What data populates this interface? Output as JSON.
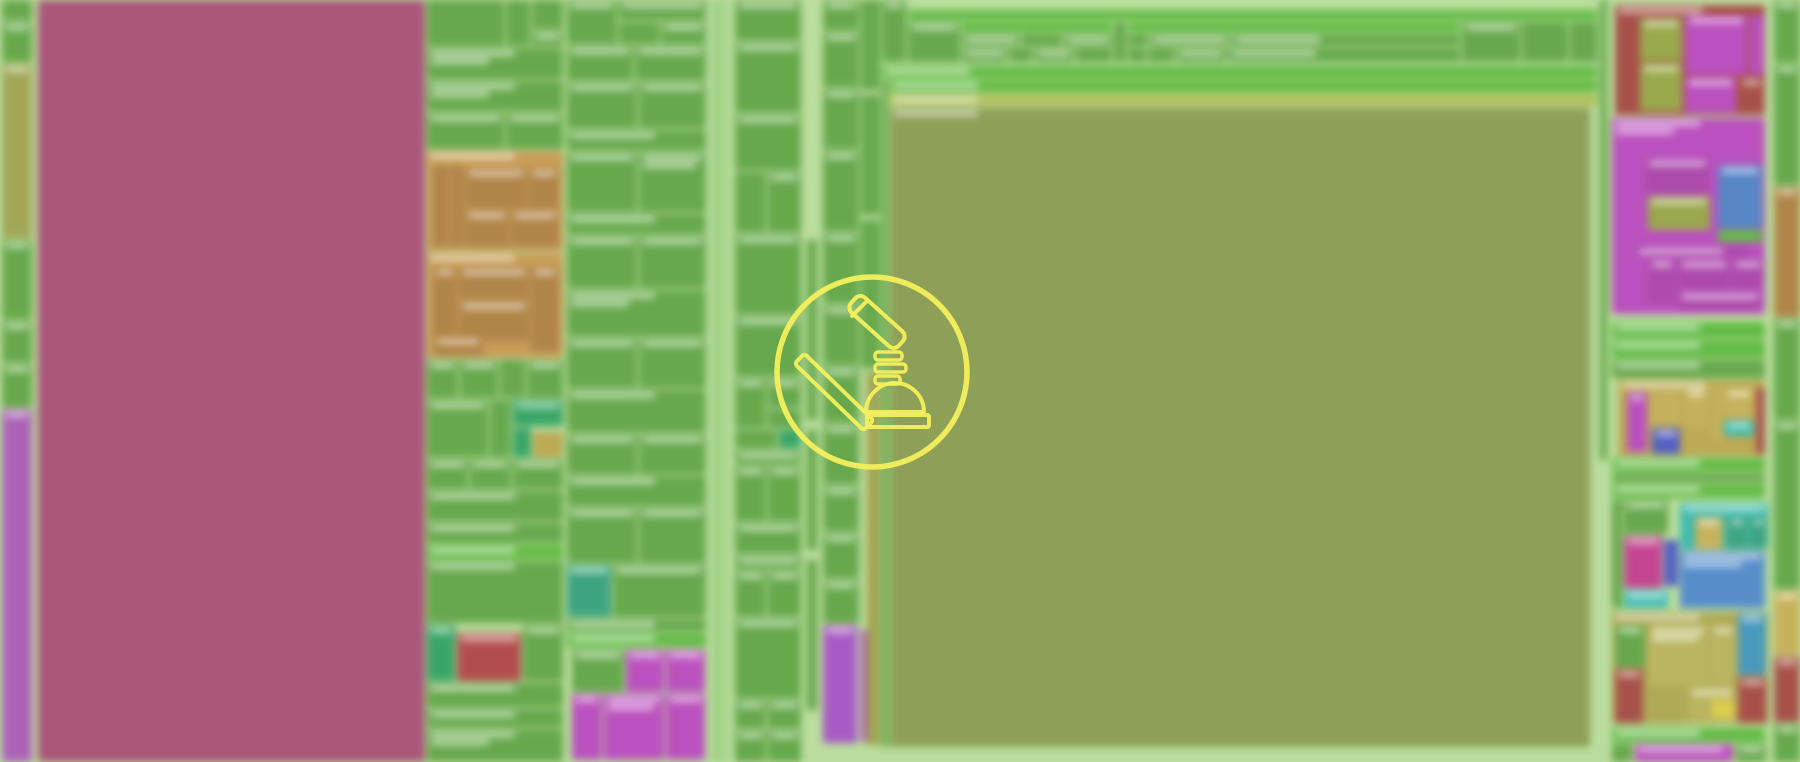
{
  "canvas": {
    "width": 1800,
    "height": 762,
    "background_color": "#b7dc98",
    "background_blur_px": 4,
    "description": "blurred treemap profiler viewport, all tile label text illegible due to blur"
  },
  "overlay_icon": {
    "name": "gavel-icon",
    "shape": "outlined gavel with spring threads and dome base inside a circle",
    "stroke_color": "#f4f05c",
    "center_x": 872,
    "center_y": 372,
    "circle_radius": 95
  },
  "palette": {
    "g": "#5ba23e",
    "gd": "#509539",
    "gb": "#57b637",
    "gl": "#8cc86e",
    "ol": "#85984a",
    "oll": "#a9ba4e",
    "olt": "#9aa04a",
    "o2": "#92a23d",
    "mr": "#a64b72",
    "pu": "#a757b4",
    "pm": "#a34fc2",
    "mg": "#b845bc",
    "mgd": "#a93fa9",
    "tn": "#c49549",
    "tnd": "#ab7c3a",
    "rd": "#a4463e",
    "rd2": "#b04242",
    "bl": "#4a7fc2",
    "bl2": "#4a86c8",
    "bl3": "#3a92b8",
    "in": "#4a56c0",
    "te": "#2f9e78",
    "te2": "#2fb6a6",
    "te3": "#38b8b0",
    "em": "#2aa05c",
    "kh": "#b8a245",
    "kh2": "#c0ab4e",
    "kh3": "#a8a348",
    "kh3l": "#b3ae52",
    "ks": "#9a9c42",
    "ye": "#d8c83a",
    "cr": "#c23a8c"
  },
  "tiles": [
    [
      2,
      0,
      30,
      20,
      "g",
      0
    ],
    [
      2,
      22,
      30,
      40,
      "g",
      1
    ],
    [
      2,
      64,
      30,
      174,
      "olt",
      1
    ],
    [
      2,
      240,
      30,
      79,
      "g",
      1
    ],
    [
      2,
      321,
      30,
      41,
      "g",
      1
    ],
    [
      2,
      364,
      30,
      43,
      "g",
      1
    ],
    [
      2,
      409,
      30,
      353,
      "pu",
      1
    ],
    [
      38,
      0,
      387,
      762,
      "mr",
      0
    ],
    [
      427,
      0,
      77,
      46,
      "g",
      0
    ],
    [
      506,
      0,
      24,
      46,
      "g",
      0
    ],
    [
      532,
      0,
      31,
      29,
      "g",
      0
    ],
    [
      532,
      31,
      31,
      15,
      "g",
      1
    ],
    [
      427,
      48,
      136,
      31,
      "g",
      2
    ],
    [
      427,
      81,
      136,
      30,
      "g",
      2
    ],
    [
      427,
      113,
      77,
      36,
      "g",
      1
    ],
    [
      506,
      113,
      57,
      36,
      "g",
      1
    ],
    [
      427,
      151,
      136,
      100,
      "tn",
      1
    ],
    [
      433,
      165,
      16,
      82,
      "tnd",
      0
    ],
    [
      451,
      165,
      12,
      82,
      "tnd",
      0
    ],
    [
      465,
      168,
      62,
      40,
      "tnd",
      1
    ],
    [
      529,
      168,
      30,
      40,
      "tnd",
      1
    ],
    [
      465,
      210,
      44,
      37,
      "tnd",
      1
    ],
    [
      511,
      210,
      48,
      37,
      "tnd",
      1
    ],
    [
      427,
      253,
      136,
      105,
      "tn",
      1
    ],
    [
      433,
      267,
      24,
      84,
      "tnd",
      1
    ],
    [
      459,
      267,
      70,
      32,
      "tnd",
      1
    ],
    [
      459,
      301,
      70,
      40,
      "tnd",
      1
    ],
    [
      531,
      267,
      28,
      84,
      "tnd",
      1
    ],
    [
      433,
      336,
      50,
      20,
      "tnd",
      1
    ],
    [
      427,
      360,
      31,
      38,
      "g",
      1
    ],
    [
      460,
      360,
      38,
      38,
      "g",
      1
    ],
    [
      500,
      360,
      25,
      38,
      "g",
      0
    ],
    [
      527,
      360,
      36,
      38,
      "g",
      1
    ],
    [
      427,
      400,
      61,
      57,
      "g",
      1
    ],
    [
      490,
      400,
      21,
      57,
      "g",
      0
    ],
    [
      513,
      400,
      50,
      26,
      "em",
      1
    ],
    [
      513,
      428,
      18,
      29,
      "em",
      0
    ],
    [
      533,
      432,
      30,
      25,
      "kh",
      0
    ],
    [
      427,
      459,
      41,
      30,
      "g",
      1
    ],
    [
      470,
      459,
      41,
      30,
      "g",
      1
    ],
    [
      513,
      459,
      50,
      30,
      "g",
      1
    ],
    [
      427,
      491,
      136,
      30,
      "g",
      1
    ],
    [
      427,
      523,
      136,
      20,
      "g",
      1
    ],
    [
      427,
      545,
      136,
      14,
      "gb",
      1
    ],
    [
      427,
      561,
      136,
      62,
      "g",
      1
    ],
    [
      427,
      625,
      28,
      56,
      "em",
      1
    ],
    [
      457,
      633,
      64,
      48,
      "rd2",
      1
    ],
    [
      523,
      625,
      40,
      56,
      "g",
      1
    ],
    [
      427,
      683,
      136,
      24,
      "g",
      1
    ],
    [
      427,
      709,
      136,
      18,
      "g",
      1
    ],
    [
      427,
      729,
      136,
      33,
      "g",
      2
    ],
    [
      567,
      0,
      50,
      44,
      "g",
      1
    ],
    [
      619,
      0,
      87,
      20,
      "g",
      1
    ],
    [
      619,
      22,
      40,
      22,
      "g",
      0
    ],
    [
      661,
      22,
      45,
      22,
      "g",
      1
    ],
    [
      567,
      46,
      66,
      34,
      "g",
      1
    ],
    [
      635,
      46,
      71,
      34,
      "g",
      1
    ],
    [
      567,
      82,
      70,
      46,
      "g",
      1
    ],
    [
      639,
      82,
      67,
      46,
      "g",
      1
    ],
    [
      567,
      130,
      139,
      20,
      "g",
      1
    ],
    [
      567,
      152,
      70,
      60,
      "g",
      1
    ],
    [
      639,
      152,
      67,
      60,
      "g",
      2
    ],
    [
      567,
      214,
      139,
      20,
      "g",
      1
    ],
    [
      567,
      236,
      70,
      52,
      "g",
      1
    ],
    [
      639,
      236,
      67,
      52,
      "g",
      1
    ],
    [
      567,
      290,
      139,
      46,
      "g",
      2
    ],
    [
      567,
      338,
      70,
      50,
      "g",
      1
    ],
    [
      639,
      338,
      67,
      50,
      "g",
      1
    ],
    [
      567,
      390,
      139,
      42,
      "g",
      1
    ],
    [
      567,
      434,
      70,
      40,
      "g",
      1
    ],
    [
      639,
      434,
      67,
      40,
      "g",
      1
    ],
    [
      567,
      476,
      139,
      30,
      "g",
      1
    ],
    [
      567,
      508,
      70,
      55,
      "g",
      1
    ],
    [
      639,
      508,
      67,
      55,
      "g",
      1
    ],
    [
      567,
      565,
      44,
      52,
      "te",
      1
    ],
    [
      613,
      565,
      93,
      52,
      "g",
      1
    ],
    [
      567,
      619,
      139,
      12,
      "g",
      1
    ],
    [
      567,
      633,
      139,
      14,
      "gb",
      1
    ],
    [
      572,
      650,
      52,
      42,
      "g",
      1
    ],
    [
      626,
      650,
      38,
      42,
      "mg",
      1
    ],
    [
      666,
      650,
      39,
      42,
      "mg",
      1
    ],
    [
      572,
      694,
      30,
      66,
      "mg",
      1
    ],
    [
      604,
      694,
      60,
      66,
      "mg",
      2
    ],
    [
      666,
      694,
      39,
      66,
      "mg",
      1
    ],
    [
      713,
      0,
      6,
      762,
      "gl",
      0
    ],
    [
      722,
      0,
      4,
      762,
      "gl",
      0
    ],
    [
      807,
      240,
      10,
      180,
      "g",
      0
    ],
    [
      807,
      430,
      10,
      120,
      "g",
      0
    ],
    [
      807,
      560,
      10,
      150,
      "g",
      0
    ],
    [
      735,
      0,
      66,
      40,
      "g",
      1
    ],
    [
      735,
      42,
      66,
      70,
      "g",
      1
    ],
    [
      735,
      114,
      66,
      56,
      "g",
      1
    ],
    [
      735,
      172,
      31,
      60,
      "g",
      0
    ],
    [
      768,
      172,
      33,
      60,
      "g",
      1
    ],
    [
      735,
      234,
      66,
      80,
      "g",
      1
    ],
    [
      735,
      316,
      66,
      60,
      "g",
      1
    ],
    [
      735,
      378,
      31,
      50,
      "g",
      1
    ],
    [
      768,
      378,
      33,
      30,
      "g",
      1
    ],
    [
      768,
      410,
      33,
      18,
      "g",
      0
    ],
    [
      735,
      430,
      42,
      18,
      "g",
      0
    ],
    [
      779,
      430,
      22,
      18,
      "em",
      0
    ],
    [
      735,
      450,
      66,
      14,
      "g",
      1
    ],
    [
      735,
      466,
      31,
      55,
      "g",
      1
    ],
    [
      768,
      466,
      33,
      55,
      "g",
      1
    ],
    [
      735,
      523,
      66,
      30,
      "g",
      1
    ],
    [
      735,
      555,
      66,
      14,
      "g",
      1
    ],
    [
      735,
      571,
      31,
      45,
      "g",
      1
    ],
    [
      768,
      571,
      33,
      45,
      "g",
      1
    ],
    [
      735,
      618,
      66,
      80,
      "g",
      1
    ],
    [
      735,
      700,
      31,
      28,
      "g",
      1
    ],
    [
      768,
      700,
      33,
      28,
      "g",
      1
    ],
    [
      735,
      730,
      31,
      32,
      "g",
      1
    ],
    [
      768,
      730,
      33,
      32,
      "g",
      1
    ],
    [
      823,
      0,
      36,
      30,
      "g",
      1
    ],
    [
      823,
      32,
      36,
      55,
      "g",
      1
    ],
    [
      823,
      89,
      36,
      60,
      "g",
      1
    ],
    [
      823,
      151,
      36,
      80,
      "g",
      1
    ],
    [
      823,
      233,
      36,
      70,
      "g",
      1
    ],
    [
      823,
      305,
      36,
      60,
      "g",
      1
    ],
    [
      823,
      367,
      36,
      55,
      "g",
      1
    ],
    [
      823,
      424,
      36,
      60,
      "g",
      1
    ],
    [
      823,
      486,
      36,
      45,
      "g",
      1
    ],
    [
      823,
      533,
      36,
      45,
      "g",
      1
    ],
    [
      823,
      580,
      36,
      43,
      "g",
      1
    ],
    [
      823,
      625,
      34,
      118,
      "pm",
      1
    ],
    [
      861,
      630,
      8,
      112,
      "pu",
      0
    ],
    [
      861,
      0,
      19,
      90,
      "g",
      0
    ],
    [
      861,
      95,
      19,
      120,
      "g",
      0
    ],
    [
      861,
      220,
      19,
      148,
      "g",
      0
    ],
    [
      867,
      372,
      13,
      373,
      "ks",
      0
    ],
    [
      882,
      0,
      24,
      62,
      "g",
      1
    ],
    [
      908,
      10,
      689,
      10,
      "gb",
      1
    ],
    [
      908,
      22,
      52,
      40,
      "g",
      1
    ],
    [
      962,
      22,
      150,
      10,
      "gb",
      1
    ],
    [
      962,
      34,
      58,
      12,
      "g",
      1
    ],
    [
      1022,
      34,
      40,
      12,
      "g",
      0
    ],
    [
      1064,
      34,
      48,
      12,
      "g",
      1
    ],
    [
      962,
      48,
      46,
      14,
      "g",
      1
    ],
    [
      1010,
      48,
      22,
      14,
      "g",
      0
    ],
    [
      1034,
      48,
      40,
      14,
      "g",
      1
    ],
    [
      1076,
      48,
      36,
      14,
      "g",
      0
    ],
    [
      1114,
      22,
      12,
      40,
      "g",
      0
    ],
    [
      1128,
      22,
      332,
      10,
      "gb",
      1
    ],
    [
      1128,
      34,
      20,
      12,
      "g",
      0
    ],
    [
      1150,
      34,
      80,
      12,
      "g",
      1
    ],
    [
      1232,
      34,
      228,
      12,
      "g",
      1
    ],
    [
      1128,
      48,
      18,
      14,
      "g",
      0
    ],
    [
      1148,
      48,
      26,
      14,
      "g",
      0
    ],
    [
      1176,
      48,
      50,
      14,
      "g",
      1
    ],
    [
      1228,
      48,
      232,
      14,
      "g",
      1
    ],
    [
      1462,
      22,
      58,
      40,
      "g",
      1
    ],
    [
      1522,
      22,
      46,
      40,
      "g",
      0
    ],
    [
      1570,
      22,
      27,
      40,
      "g",
      0
    ],
    [
      882,
      66,
      715,
      12,
      "gb",
      1
    ],
    [
      882,
      80,
      6,
      667,
      "g",
      0
    ],
    [
      890,
      80,
      707,
      12,
      "gb",
      1
    ],
    [
      890,
      94,
      707,
      12,
      "oll",
      1
    ],
    [
      890,
      108,
      700,
      639,
      "ol",
      1
    ],
    [
      1600,
      0,
      7,
      460,
      "g",
      0
    ],
    [
      1615,
      5,
      150,
      110,
      "rd",
      1
    ],
    [
      1640,
      18,
      42,
      43,
      "o2",
      1
    ],
    [
      1640,
      63,
      42,
      48,
      "o2",
      1
    ],
    [
      1685,
      15,
      62,
      60,
      "mg",
      1
    ],
    [
      1750,
      15,
      14,
      60,
      "mg",
      0
    ],
    [
      1685,
      77,
      51,
      36,
      "mg",
      1
    ],
    [
      1739,
      77,
      25,
      36,
      "rd",
      1
    ],
    [
      1612,
      118,
      153,
      196,
      "mg",
      2
    ],
    [
      1645,
      158,
      65,
      36,
      "mgd",
      1
    ],
    [
      1718,
      165,
      44,
      63,
      "bl",
      1
    ],
    [
      1648,
      196,
      62,
      34,
      "o2",
      1
    ],
    [
      1718,
      230,
      44,
      12,
      "gb",
      0
    ],
    [
      1635,
      246,
      112,
      11,
      "mgd",
      1
    ],
    [
      1648,
      259,
      28,
      44,
      "mgd",
      1
    ],
    [
      1678,
      259,
      52,
      30,
      "mgd",
      1
    ],
    [
      1732,
      259,
      32,
      30,
      "mgd",
      1
    ],
    [
      1678,
      291,
      84,
      19,
      "mgd",
      1
    ],
    [
      1612,
      322,
      153,
      16,
      "gb",
      1
    ],
    [
      1612,
      340,
      153,
      18,
      "gb",
      1
    ],
    [
      1612,
      360,
      153,
      18,
      "g",
      1
    ],
    [
      1618,
      380,
      147,
      76,
      "kh",
      1
    ],
    [
      1627,
      392,
      20,
      60,
      "mg",
      1
    ],
    [
      1650,
      392,
      30,
      32,
      "kh2",
      0
    ],
    [
      1652,
      428,
      28,
      26,
      "in",
      1
    ],
    [
      1684,
      388,
      24,
      40,
      "kh2",
      1
    ],
    [
      1712,
      385,
      10,
      55,
      "kh2",
      0
    ],
    [
      1724,
      420,
      30,
      16,
      "te2",
      1
    ],
    [
      1724,
      388,
      30,
      30,
      "kh2",
      1
    ],
    [
      1756,
      388,
      9,
      66,
      "rd",
      0
    ],
    [
      1612,
      458,
      153,
      14,
      "gb",
      1
    ],
    [
      1612,
      474,
      153,
      8,
      "g",
      0
    ],
    [
      1612,
      484,
      153,
      14,
      "gb",
      1
    ],
    [
      1612,
      500,
      10,
      108,
      "g",
      0
    ],
    [
      1624,
      500,
      44,
      34,
      "g",
      1
    ],
    [
      1624,
      536,
      38,
      52,
      "cr",
      1
    ],
    [
      1664,
      540,
      14,
      46,
      "in",
      0
    ],
    [
      1680,
      503,
      88,
      46,
      "te2",
      1
    ],
    [
      1695,
      517,
      28,
      32,
      "kh2",
      1
    ],
    [
      1727,
      517,
      20,
      32,
      "te",
      1
    ],
    [
      1750,
      517,
      17,
      32,
      "te",
      1
    ],
    [
      1680,
      551,
      85,
      57,
      "bl2",
      2
    ],
    [
      1624,
      590,
      44,
      18,
      "te3",
      1
    ],
    [
      1612,
      612,
      156,
      112,
      "kh3",
      1
    ],
    [
      1615,
      625,
      30,
      42,
      "g",
      1
    ],
    [
      1615,
      669,
      28,
      54,
      "rd",
      1
    ],
    [
      1648,
      625,
      60,
      60,
      "kh3l",
      2
    ],
    [
      1710,
      625,
      26,
      60,
      "kh3l",
      1
    ],
    [
      1738,
      613,
      28,
      62,
      "bl3",
      1
    ],
    [
      1738,
      677,
      29,
      46,
      "rd",
      1
    ],
    [
      1688,
      687,
      48,
      36,
      "kh3l",
      1
    ],
    [
      1712,
      700,
      22,
      18,
      "ye",
      0
    ],
    [
      1612,
      728,
      153,
      14,
      "gb",
      1
    ],
    [
      1612,
      744,
      20,
      18,
      "g",
      0
    ],
    [
      1635,
      744,
      98,
      18,
      "mg",
      1
    ],
    [
      1736,
      744,
      30,
      18,
      "g",
      1
    ],
    [
      1774,
      0,
      26,
      62,
      "g",
      1
    ],
    [
      1774,
      64,
      26,
      121,
      "g",
      1
    ],
    [
      1774,
      187,
      26,
      130,
      "tnd",
      1
    ],
    [
      1774,
      319,
      26,
      100,
      "g",
      1
    ],
    [
      1774,
      421,
      26,
      168,
      "g",
      1
    ],
    [
      1774,
      591,
      26,
      64,
      "kh2",
      1
    ],
    [
      1774,
      657,
      26,
      65,
      "rd",
      1
    ],
    [
      1774,
      724,
      26,
      38,
      "g",
      1
    ]
  ]
}
